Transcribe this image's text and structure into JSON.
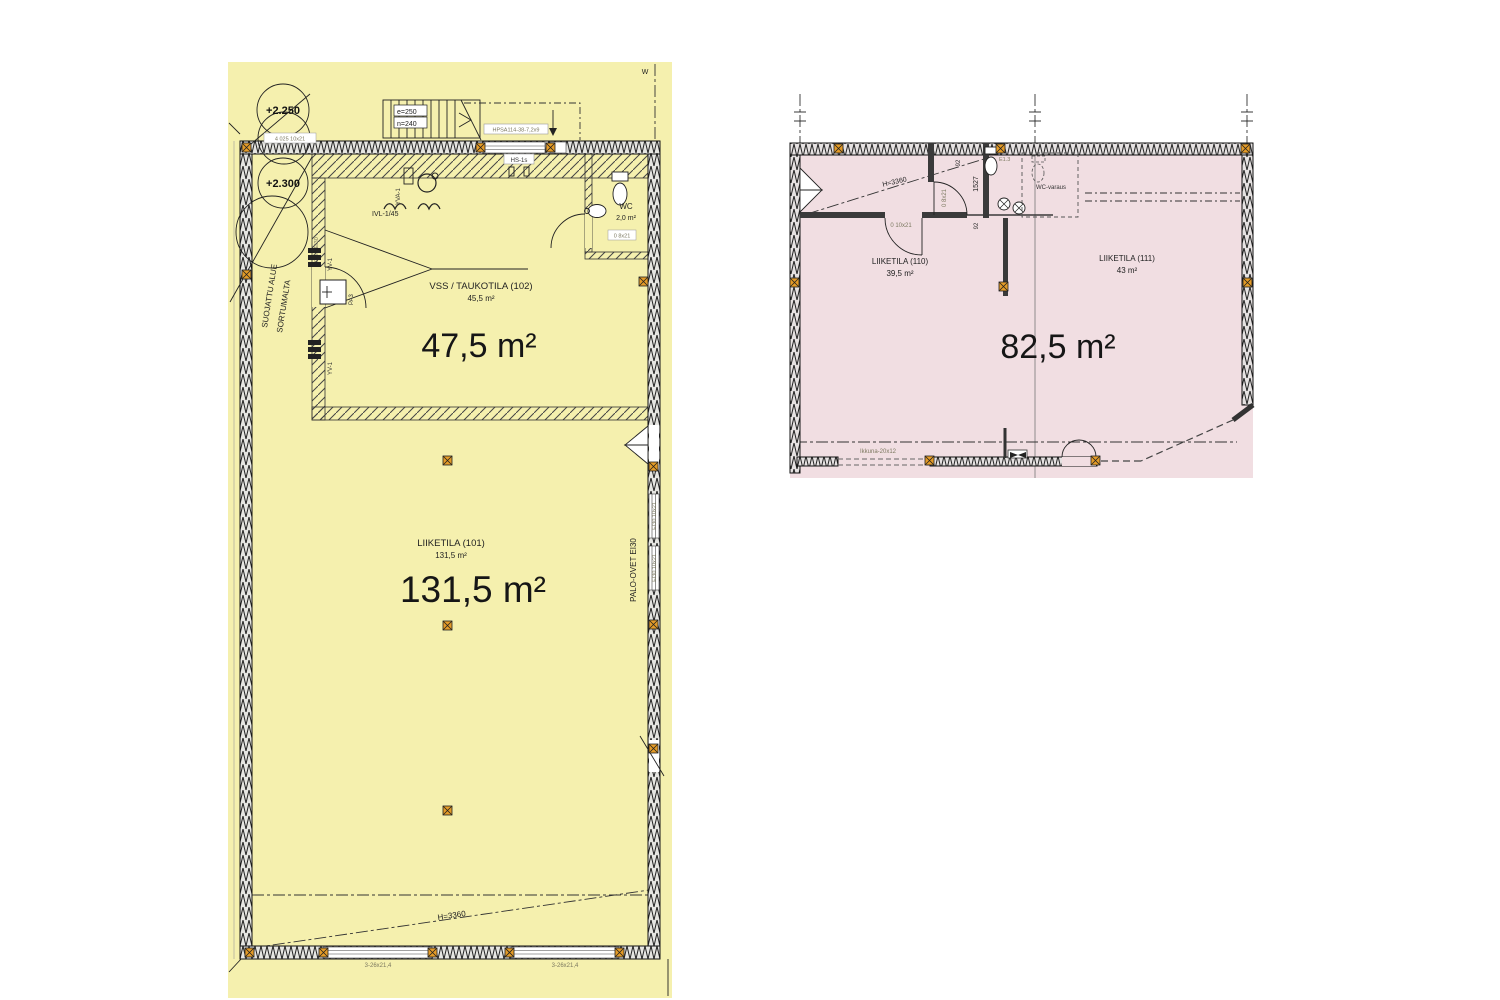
{
  "colors": {
    "left_bg": "#f5f0ae",
    "right_bg": "#f1dee2",
    "marker": "#e49b27",
    "wall": "#1f1f1f"
  },
  "left_plan": {
    "elev_upper": "+2.250",
    "elev_lower": "+2.300",
    "window_tag_topleft": "4 025 10x21",
    "stair_e": "e=250",
    "stair_n": "n=240",
    "beam_tag": "HPSA114-38-7,2x9",
    "grid_tag": "W",
    "hs_tag": "HS-1s",
    "wc": {
      "name": "WC",
      "area": "2,0 m²",
      "door_tag": "0 8x21"
    },
    "protected_line1": "SUOJATTU ALUE",
    "protected_line2": "SORTUMALTA",
    "ivl_tag": "IVL-1/45",
    "door_ei_tag": "9x21 EI30",
    "yv_tag": "YV-1",
    "yva_tag": "YVA-1",
    "pa_tag": "PA3",
    "vss": {
      "title": "VSS / TAUKOTILA (102)",
      "area_sub": "45,5 m²",
      "area_big": "47,5 m²"
    },
    "shop": {
      "title": "LIIKETILA (101)",
      "area_sub": "131,5 m²",
      "area_big": "131,5 m²"
    },
    "fire_door_tag": "PALO-OVET EI30",
    "right_door_tag": "EI30 10x21",
    "height_tag": "H=3360",
    "window_tag_bottom": "3-26x21,4"
  },
  "right_plan": {
    "height_tag": "H=3360",
    "dim_92": "92",
    "dim_1527": "1527",
    "fixture_tag": "E1.3",
    "wc_reserve_tag": "WC-varaus",
    "door_tag_corridor": "0 10x21",
    "door_tag_wc": "0 8x21",
    "shop110": {
      "title": "LIIKETILA (110)",
      "area": "39,5 m²"
    },
    "shop111": {
      "title": "LIIKETILA (111)",
      "area": "43 m²"
    },
    "area_big": "82,5 m²",
    "window_tag": "Ikkuna-20x12"
  }
}
